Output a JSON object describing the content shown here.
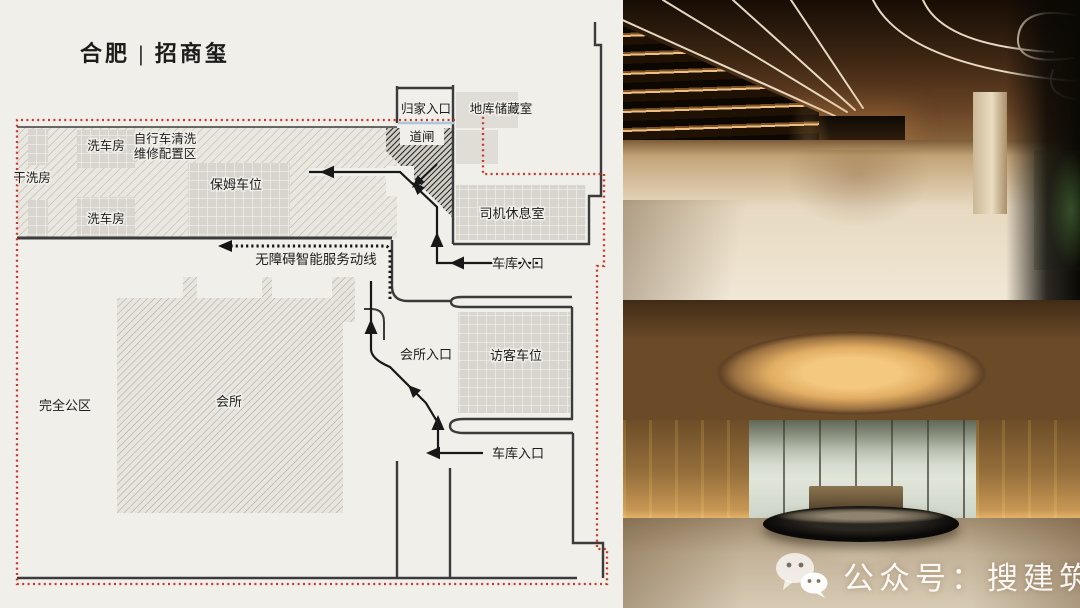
{
  "title": "合肥 | 招商玺",
  "plan": {
    "labels": {
      "home_entrance": "归家入口",
      "basement_storage": "地库储藏室",
      "barrier_gate": "道闸",
      "dry_clean_room": "干洗房",
      "car_wash_top": "洗车房",
      "bike_area_line1": "自行车清洗",
      "bike_area_line2": "维修配置区",
      "nanny_parking": "保姆车位",
      "car_wash_bottom": "洗车房",
      "driver_lounge": "司机休息室",
      "garage_entrance_top": "车库入口",
      "accessible_route": "无障碍智能服务动线",
      "club_entrance": "会所入口",
      "visitor_parking": "访客车位",
      "club": "会所",
      "public_area": "完全公区",
      "garage_entrance_bottom": "车库入口"
    },
    "colors": {
      "boundary_red": "#c7382d",
      "wall_dark": "#3b3b3b",
      "gate_blue": "#a9c7dd",
      "background_cream": "#f1efe9"
    }
  },
  "watermark": {
    "icon": "wechat-icon",
    "text": "公众号：搜建筑"
  }
}
